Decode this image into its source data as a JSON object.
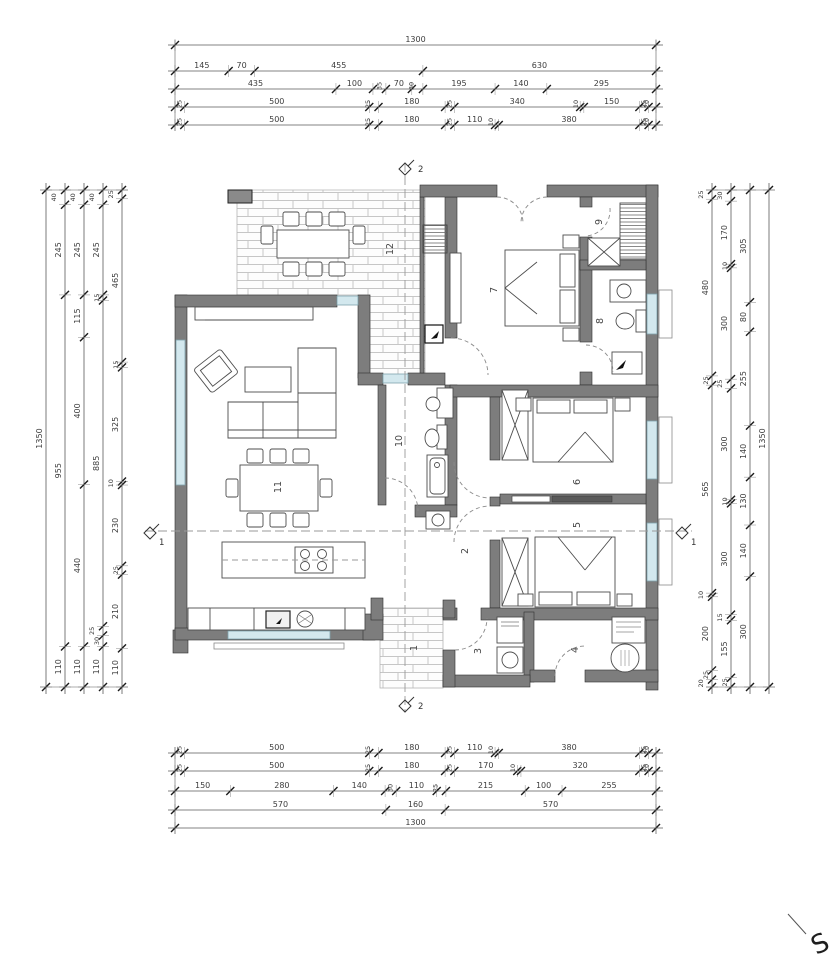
{
  "drawing": {
    "type": "floor-plan",
    "compass": {
      "label": "S"
    },
    "room_numbers": [
      {
        "label": "1",
        "x": 417,
        "y": 648
      },
      {
        "label": "2",
        "x": 468,
        "y": 551
      },
      {
        "label": "3",
        "x": 481,
        "y": 651
      },
      {
        "label": "4",
        "x": 578,
        "y": 650
      },
      {
        "label": "5",
        "x": 580,
        "y": 525
      },
      {
        "label": "6",
        "x": 580,
        "y": 482
      },
      {
        "label": "7",
        "x": 497,
        "y": 290
      },
      {
        "label": "8",
        "x": 603,
        "y": 321
      },
      {
        "label": "9",
        "x": 602,
        "y": 222
      },
      {
        "label": "10",
        "x": 402,
        "y": 441
      },
      {
        "label": "11",
        "x": 281,
        "y": 487
      },
      {
        "label": "12",
        "x": 393,
        "y": 249
      }
    ],
    "section_markers": [
      {
        "label": "1",
        "x": 150,
        "y": 533,
        "dx": 9,
        "dy": 12
      },
      {
        "label": "1",
        "x": 682,
        "y": 533,
        "dx": 9,
        "dy": 12
      },
      {
        "label": "2",
        "x": 405,
        "y": 169,
        "dx": 13,
        "dy": 3
      },
      {
        "label": "2",
        "x": 405,
        "y": 706,
        "dx": 13,
        "dy": 3
      }
    ],
    "dimensions": {
      "top": {
        "x0": 175,
        "x1": 656,
        "rows": [
          {
            "y": 45,
            "segs": [
              1300
            ]
          },
          {
            "y": 71,
            "segs": [
              145,
              70,
              455,
              630
            ]
          },
          {
            "y": 89,
            "segs": [
              435,
              100,
              35,
              70,
              30,
              195,
              140,
              295
            ]
          },
          {
            "y": 107,
            "segs": [
              25,
              500,
              25,
              180,
              25,
              340,
              10,
              150,
              25,
              20
            ]
          },
          {
            "y": 125,
            "segs": [
              25,
              500,
              25,
              180,
              25,
              110,
              10,
              380,
              25,
              20
            ]
          }
        ]
      },
      "bottom": {
        "x0": 175,
        "x1": 656,
        "rows": [
          {
            "y": 753,
            "segs": [
              25,
              500,
              25,
              180,
              25,
              110,
              10,
              380,
              25,
              20
            ]
          },
          {
            "y": 771,
            "segs": [
              25,
              500,
              25,
              180,
              25,
              170,
              10,
              320,
              25,
              20
            ]
          },
          {
            "y": 791,
            "segs": [
              150,
              280,
              140,
              30,
              110,
              25,
              215,
              100,
              255
            ]
          },
          {
            "y": 810,
            "segs": [
              570,
              160,
              570
            ]
          },
          {
            "y": 828,
            "segs": [
              1300
            ]
          }
        ]
      },
      "left": {
        "y0": 190,
        "y1": 687,
        "cols": [
          {
            "x": 46,
            "segs": [
              1350
            ]
          },
          {
            "x": 65,
            "segs": [
              40,
              245,
              955,
              110
            ]
          },
          {
            "x": 84,
            "segs": [
              40,
              245,
              115,
              400,
              440,
              110
            ]
          },
          {
            "x": 103,
            "segs": [
              40,
              245,
              15,
              885,
              25,
              30,
              110
            ]
          },
          {
            "x": 122,
            "segs": [
              25,
              465,
              15,
              325,
              10,
              230,
              25,
              210,
              110
            ]
          }
        ]
      },
      "right": {
        "y0": 190,
        "y1": 687,
        "cols": [
          {
            "x": 712,
            "segs": [
              25,
              480,
              25,
              565,
              10,
              200,
              25,
              20
            ]
          },
          {
            "x": 731,
            "segs": [
              30,
              170,
              10,
              300,
              25,
              300,
              10,
              300,
              15,
              155,
              25
            ]
          },
          {
            "x": 750,
            "segs": [
              305,
              80,
              255,
              140,
              130,
              140,
              300
            ]
          },
          {
            "x": 769,
            "segs": [
              1350
            ]
          }
        ]
      }
    }
  }
}
